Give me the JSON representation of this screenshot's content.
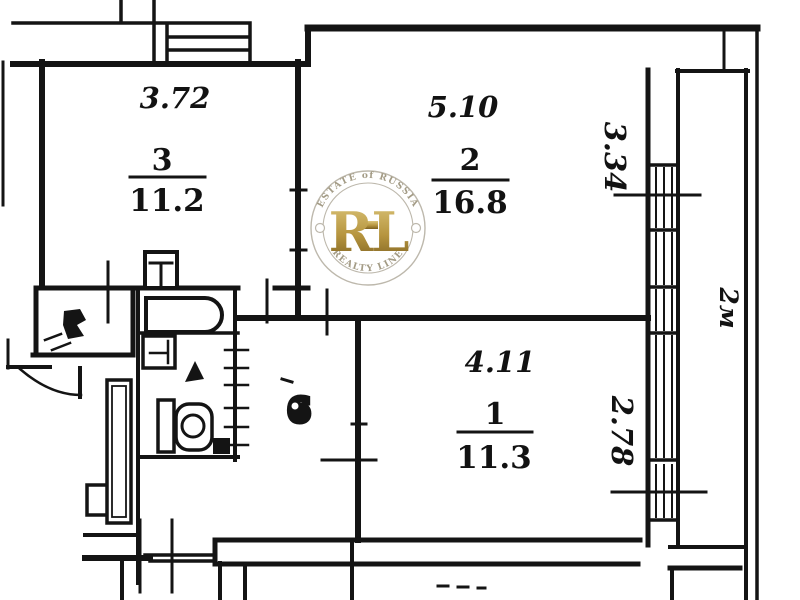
{
  "plan": {
    "rooms": [
      {
        "number": "1",
        "area": "11.3",
        "width": "4.11",
        "depth": "2.78"
      },
      {
        "number": "2",
        "area": "16.8",
        "width": "5.10",
        "depth": "3.34"
      },
      {
        "number": "3",
        "area": "11.2",
        "width": "3.72"
      }
    ],
    "hall_number": "6",
    "balcony_width": "2м",
    "fixtures": [
      "bathtub",
      "kitchen-sink",
      "washbasin",
      "toilet",
      "entrance-door",
      "ventilation-shaft",
      "built-in-closet",
      "window",
      "balcony"
    ]
  },
  "watermark": {
    "monogram": "RL",
    "arc_top": "ESTATE of RUSSIA",
    "arc_bottom": "REALTY LINE",
    "gold": "#b6953f",
    "ring_gray": "#bdb8ac"
  },
  "colors": {
    "ink": "#141414",
    "paper": "#ffffff"
  }
}
